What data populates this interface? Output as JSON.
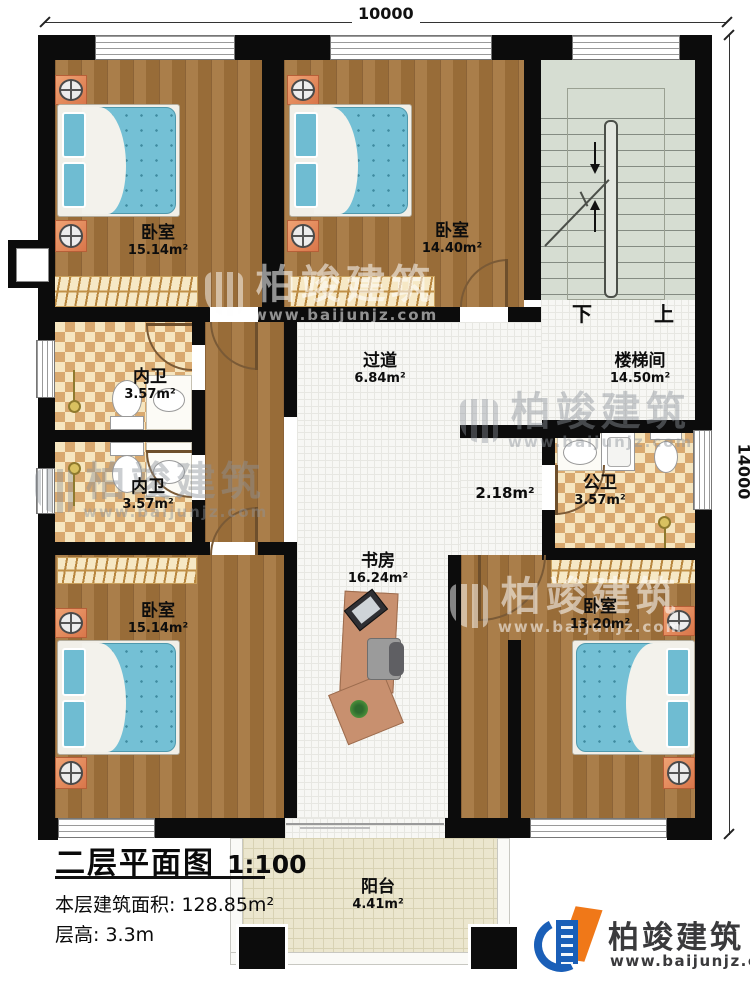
{
  "dimensions": {
    "top": "10000",
    "right": "14000"
  },
  "stair": {
    "down": "下",
    "up": "上"
  },
  "rooms": {
    "bedroom_tl": {
      "name": "卧室",
      "area": "15.14m²"
    },
    "bedroom_tm": {
      "name": "卧室",
      "area": "14.40m²"
    },
    "stairwell": {
      "name": "楼梯间",
      "area": "14.50m²"
    },
    "corridor": {
      "name": "过道",
      "area": "6.84m²"
    },
    "bath_inner_top": {
      "name": "内卫",
      "area": "3.57m²"
    },
    "bath_inner_bottom": {
      "name": "内卫",
      "area": "3.57m²"
    },
    "bath_public": {
      "name": "公卫",
      "area": "3.57m²"
    },
    "alcove": {
      "area": "2.18m²"
    },
    "study": {
      "name": "书房",
      "area": "16.24m²"
    },
    "bedroom_bl": {
      "name": "卧室",
      "area": "15.14m²"
    },
    "bedroom_br": {
      "name": "卧室",
      "area": "13.20m²"
    },
    "balcony": {
      "name": "阳台",
      "area": "4.41m²"
    }
  },
  "titleblock": {
    "plan_title": "二层平面图",
    "scale": "1:100",
    "area_label": "本层建筑面积:",
    "area_value": "128.85m²",
    "floor_height_label": "层高:",
    "floor_height_value": "3.3m"
  },
  "branding": {
    "company": "柏竣建筑",
    "website": "www.baijunjz.com"
  },
  "watermark": {
    "company": "柏竣建筑",
    "website": "www.baijunjz.com"
  },
  "colors": {
    "wall": "#0c0c0c",
    "wood": "#a4743c",
    "tile": "#f7f7f4",
    "checker_dark": "#d9a96f",
    "checker_light": "#f6e6c0",
    "stair_green": "#d6ddd2",
    "balcony": "#ebe6ce",
    "mattress_blue": "#74c0d5",
    "nightstand_orange": "#e08b5b",
    "logo_blue": "#1a5fb8",
    "logo_orange": "#f07818"
  }
}
